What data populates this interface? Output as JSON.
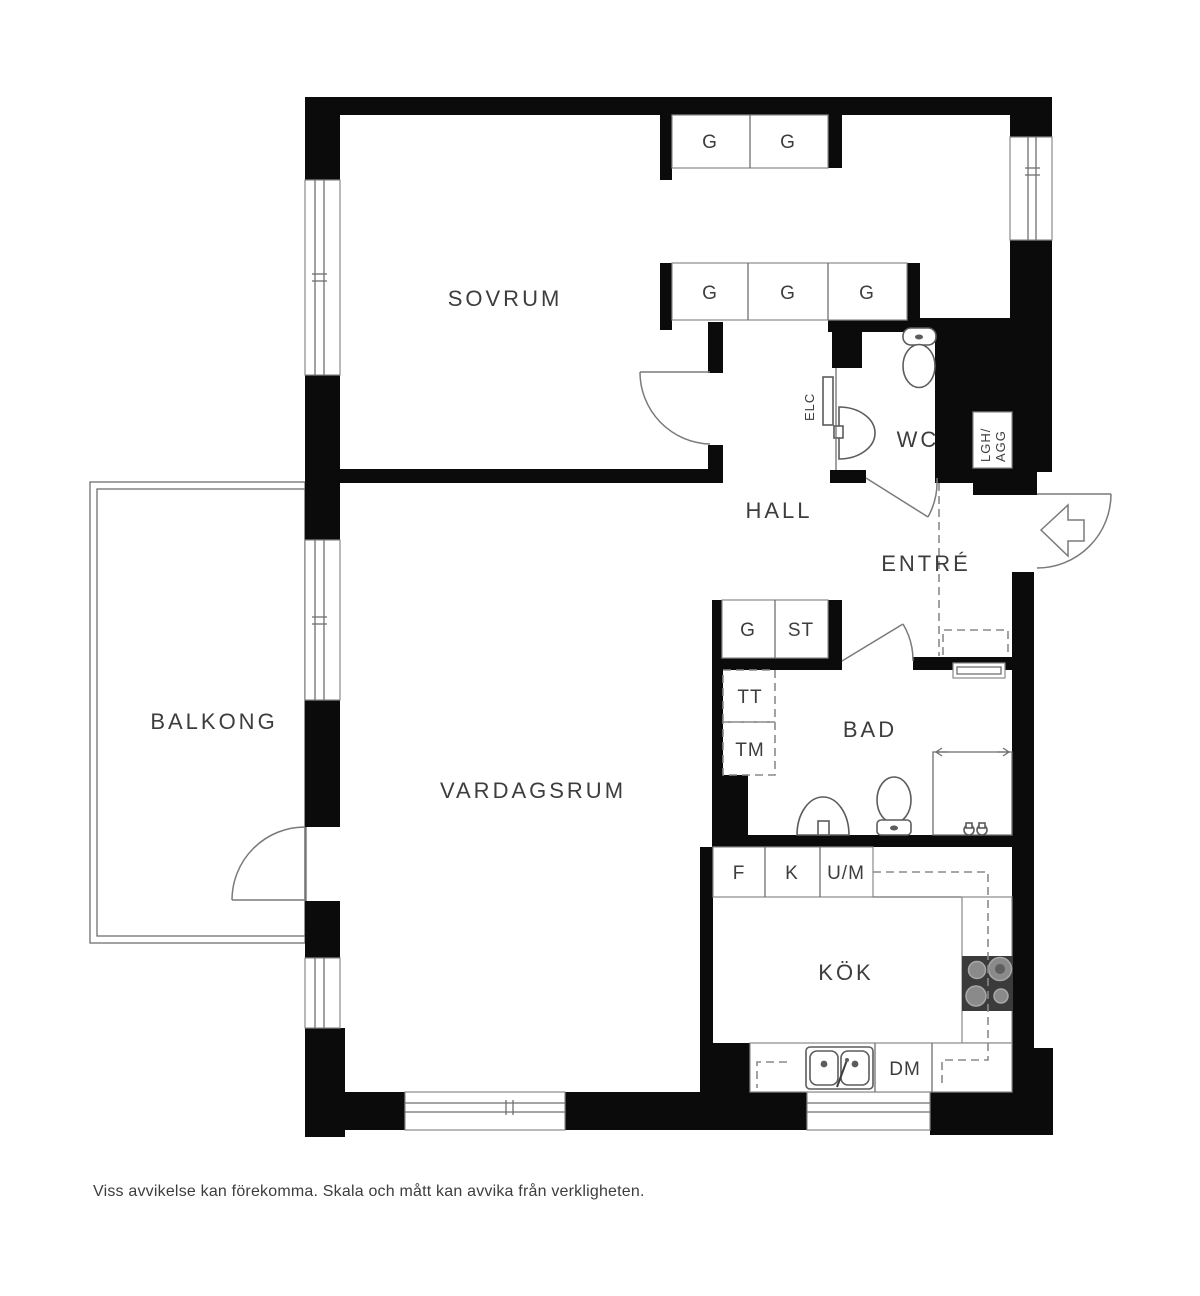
{
  "rooms": {
    "sovrum": "SOVRUM",
    "vardagsrum": "VARDAGSRUM",
    "balkong": "BALKONG",
    "hall": "HALL",
    "entre": "ENTRÉ",
    "wc": "WC",
    "bad": "BAD",
    "kok": "KÖK"
  },
  "storage": {
    "g": "G",
    "st": "ST"
  },
  "appliances": {
    "tt": "TT",
    "tm": "TM",
    "f": "F",
    "k": "K",
    "um": "U/M",
    "dm": "DM"
  },
  "technical": {
    "elc": "ELC",
    "lgh": "LGH/",
    "agg": "AGG"
  },
  "colors": {
    "wall": "#0b0b0b",
    "stove": "#3b3b3b",
    "text": "#3d3d3d"
  },
  "footer": {
    "disclaimer": "Viss avvikelse kan förekomma. Skala och mått kan avvika från verkligheten."
  }
}
